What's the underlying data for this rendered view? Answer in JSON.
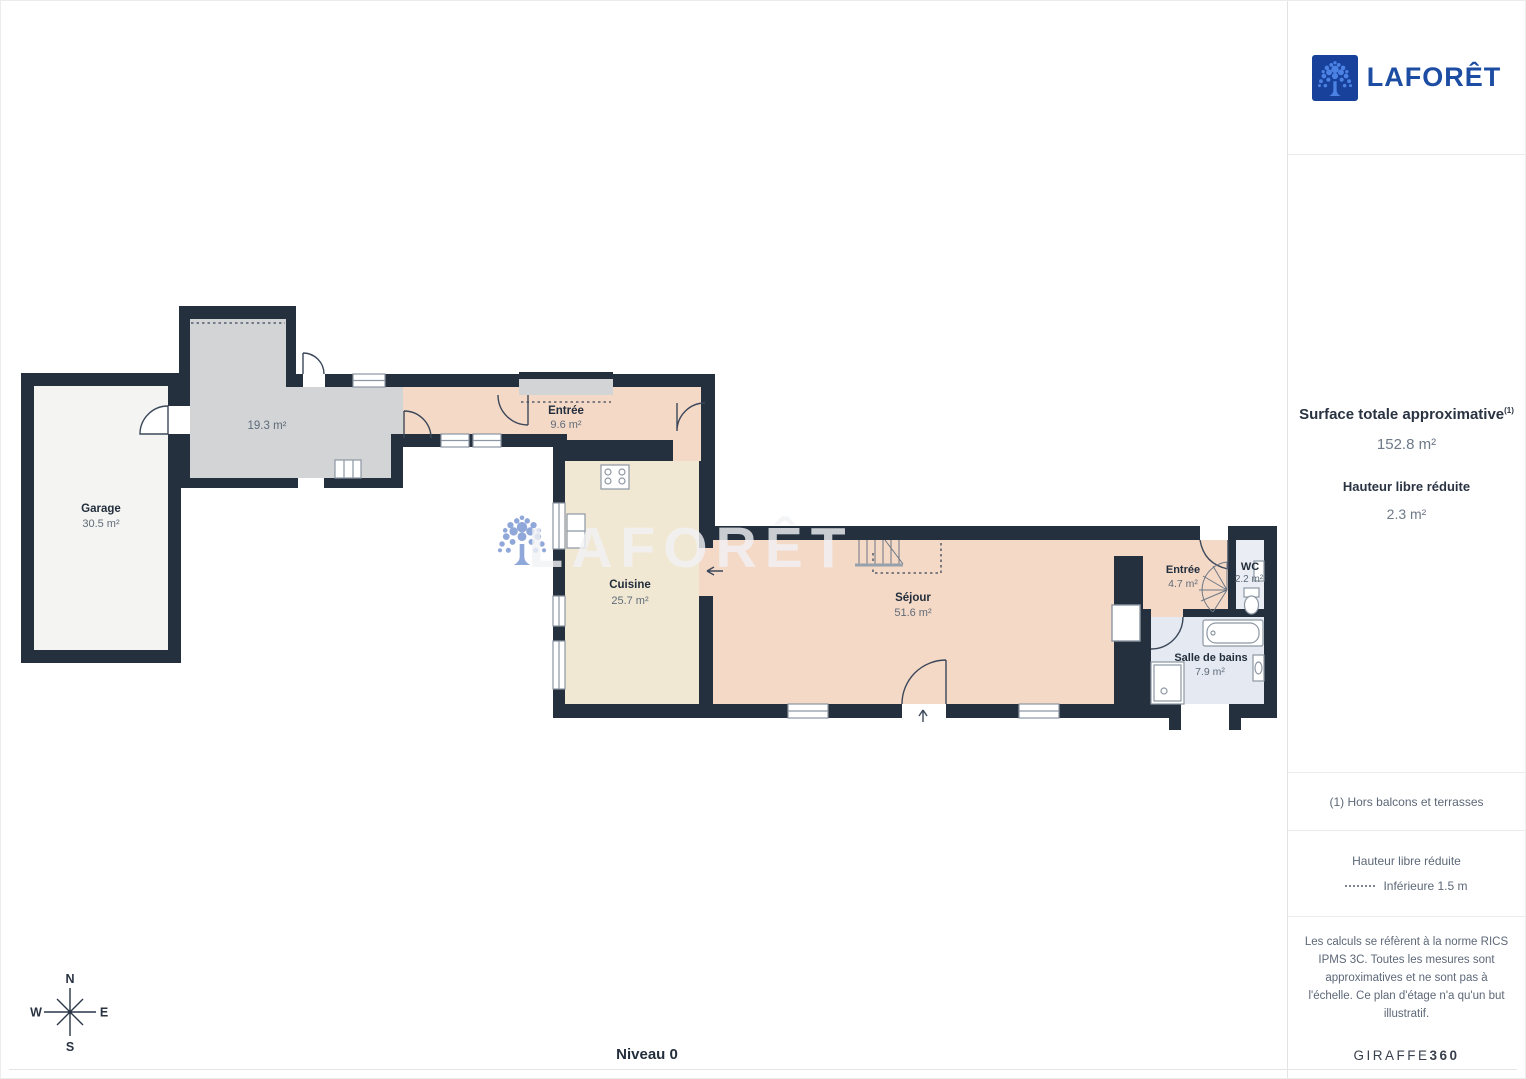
{
  "brand": {
    "name": "LAFORÊT",
    "logo_square_color": "#17419b",
    "logo_tree_color": "#4c82e4",
    "logo_text_color": "#1c4da3"
  },
  "sidebar": {
    "surface_title": "Surface totale approximative",
    "surface_ref": "(1)",
    "surface_value": "152.8 m²",
    "height_title": "Hauteur libre réduite",
    "height_value": "2.3 m²",
    "footnote": "(1) Hors balcons et terrasses",
    "legend_title": "Hauteur libre réduite",
    "legend_label": "Inférieure 1.5 m",
    "disclaimer": "Les calculs se réfèrent à la norme RICS IPMS 3C. Toutes les mesures sont approximatives et ne sont pas à l'échelle. Ce plan d'étage n'a qu'un but illustratif.",
    "maker": "GIRAFFE",
    "maker_suffix": "360"
  },
  "plan": {
    "level": "Niveau 0",
    "watermark": "LAFORÊT",
    "compass": {
      "n": "N",
      "e": "E",
      "s": "S",
      "w": "W"
    },
    "colors": {
      "wall": "#25303e",
      "living_floor": "#f5d9c7",
      "kitchen_floor": "#f1e8d3",
      "garage_floor": "#f4f4f2",
      "reduced_room_floor": "#d2d4d6",
      "bath_floor": "#e5eaf2",
      "watermark_tree": "#8ba3d8"
    },
    "rooms": {
      "garage": {
        "name": "Garage",
        "area": "30.5 m²"
      },
      "room19": {
        "area": "19.3 m²"
      },
      "entree_main": {
        "name": "Entrée",
        "area": "9.6 m²"
      },
      "cuisine": {
        "name": "Cuisine",
        "area": "25.7 m²"
      },
      "sejour": {
        "name": "Séjour",
        "area": "51.6 m²"
      },
      "entree_haut": {
        "name": "Entrée",
        "area": "4.7 m²"
      },
      "wc": {
        "name": "WC",
        "area": "2.2 m²"
      },
      "salle_de_bains": {
        "name": "Salle de bains",
        "area": "7.9 m²"
      }
    }
  }
}
